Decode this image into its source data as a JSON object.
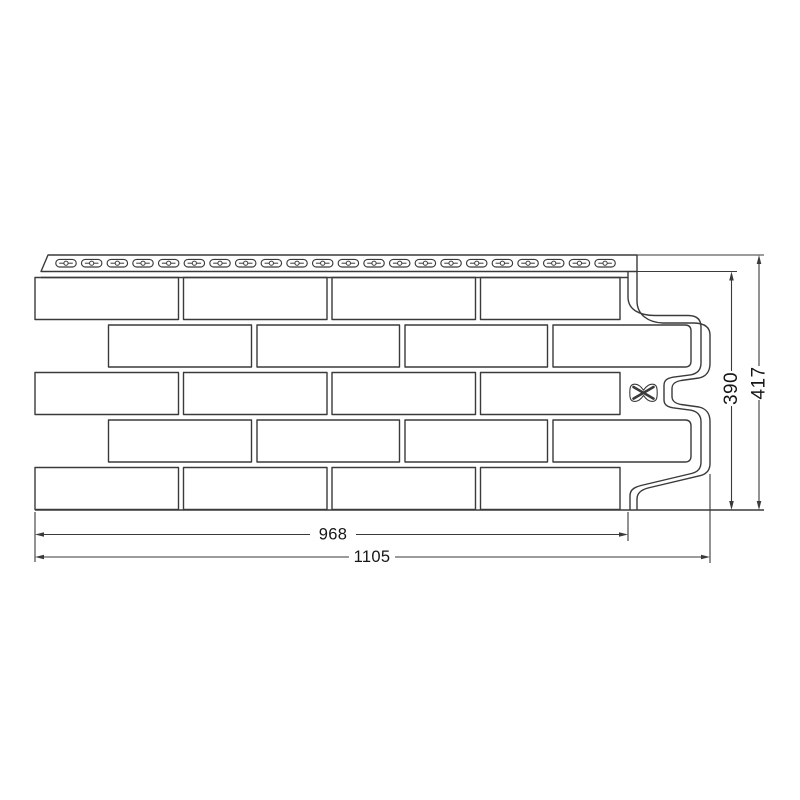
{
  "diagram": {
    "type": "technical-dimension-drawing",
    "subject": "brick-pattern facade panel with perforated nailing hem",
    "background_color": "#ffffff",
    "line_color": "#3a3a3a",
    "text_color": "#161616",
    "labels": {
      "width_inner": "968",
      "width_outer": "1105",
      "height_inner": "390",
      "height_outer": "417"
    },
    "nail_hem": {
      "slot_count": 22
    },
    "brick_grid": {
      "rows": 5,
      "bricks_per_row": 4
    },
    "fastener_mark": "x-mark"
  }
}
